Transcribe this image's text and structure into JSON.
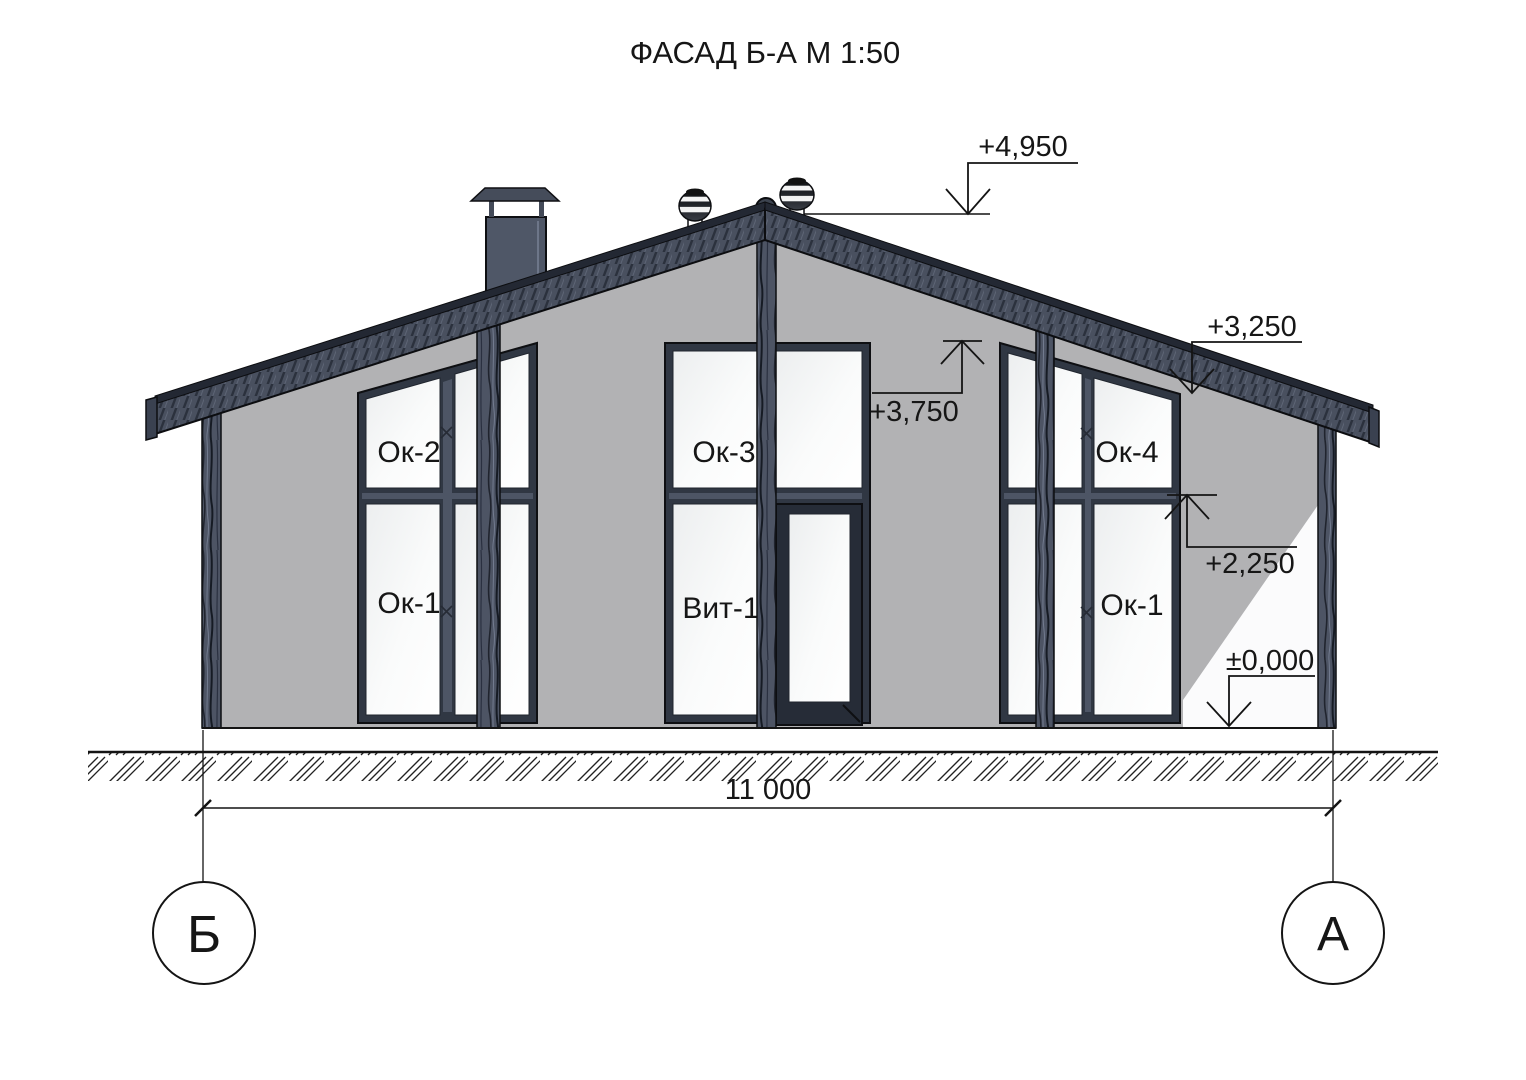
{
  "title": "ФАСАД Б-А М 1:50",
  "axes": {
    "left": "Б",
    "right": "А"
  },
  "dimension": {
    "overall_width": "11 000"
  },
  "elevations": {
    "ridge": "+4,950",
    "center_window_head": "+3,750",
    "right_eaves": "+3,250",
    "right_transom": "+2,250",
    "ground_zero": "±0,000"
  },
  "window_labels": {
    "ok2": "Ок-2",
    "ok1_left": "Ок-1",
    "ok3": "Ок-3",
    "vit1": "Вит-1",
    "ok4": "Ок-4",
    "ok1_right": "Ок-1"
  },
  "colors": {
    "wall": "#b2b2b4",
    "timber": "#4d5464",
    "roof_fascia": "#49505f",
    "window_frame": "#303743",
    "line": "#141414",
    "glass_edge": "#e9ebec"
  }
}
